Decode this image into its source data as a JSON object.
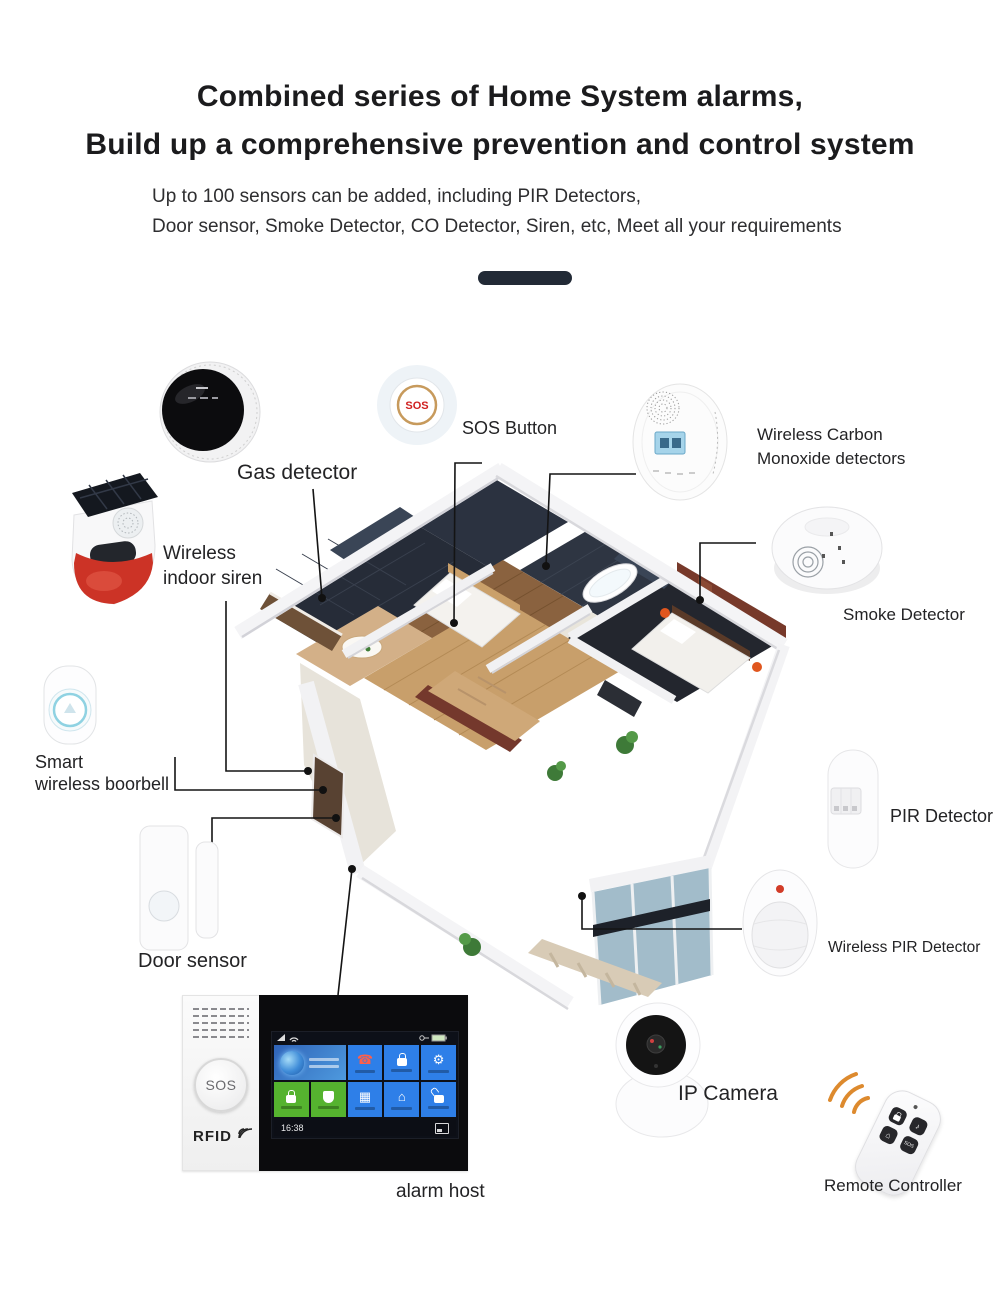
{
  "header": {
    "title_line1": "Combined series of Home System alarms,",
    "title_line2": "Build up a comprehensive prevention and control system",
    "subtitle_line1": "Up to 100 sensors can be added, including PIR Detectors,",
    "subtitle_line2": "Door sensor, Smoke Detector, CO Detector, Siren, etc, Meet all your requirements"
  },
  "labels": {
    "gas_detector": "Gas detector",
    "sos_button": "SOS Button",
    "co_detector_line1": "Wireless Carbon",
    "co_detector_line2": "Monoxide detectors",
    "smoke_detector": "Smoke Detector",
    "indoor_siren_line1": "Wireless",
    "indoor_siren_line2": "indoor siren",
    "doorbell_line1": "Smart",
    "doorbell_line2": "wireless boorbell",
    "door_sensor": "Door sensor",
    "pir_detector": "PIR Detector",
    "wireless_pir_detector": "Wireless PIR Detector",
    "ip_camera": "IP Camera",
    "remote_controller": "Remote Controller",
    "alarm_host": "alarm host"
  },
  "devices": {
    "sos_button_text": "SOS"
  },
  "alarm_host": {
    "sos_label": "SOS",
    "rfid_label": "RFID",
    "screen_time": "16:38",
    "tiles": [
      {
        "icon": "globe",
        "color": "#2f63b8",
        "wide": true
      },
      {
        "icon": "phone",
        "color": "#2e7fe8"
      },
      {
        "icon": "lock",
        "color": "#2e7fe8"
      },
      {
        "icon": "gear",
        "color": "#2e7fe8"
      },
      {
        "icon": "lock",
        "color": "#55b32f"
      },
      {
        "icon": "shield",
        "color": "#55b32f"
      },
      {
        "icon": "photo",
        "color": "#2e7fe8"
      },
      {
        "icon": "home",
        "color": "#2e7fe8"
      },
      {
        "icon": "unlock",
        "color": "#2e7fe8"
      }
    ]
  },
  "remote": {
    "buttons": [
      {
        "icon": "lock"
      },
      {
        "icon": "bell"
      },
      {
        "icon": "home"
      },
      {
        "icon": "sos",
        "label": "SOS"
      }
    ]
  },
  "colors": {
    "accent_dark": "#222a36",
    "tile_blue": "#2e7fe8",
    "tile_green": "#55b32f",
    "siren_red": "#cc3326",
    "sos_red": "#cf1f1f",
    "wave_orange": "#dd8a2e"
  }
}
